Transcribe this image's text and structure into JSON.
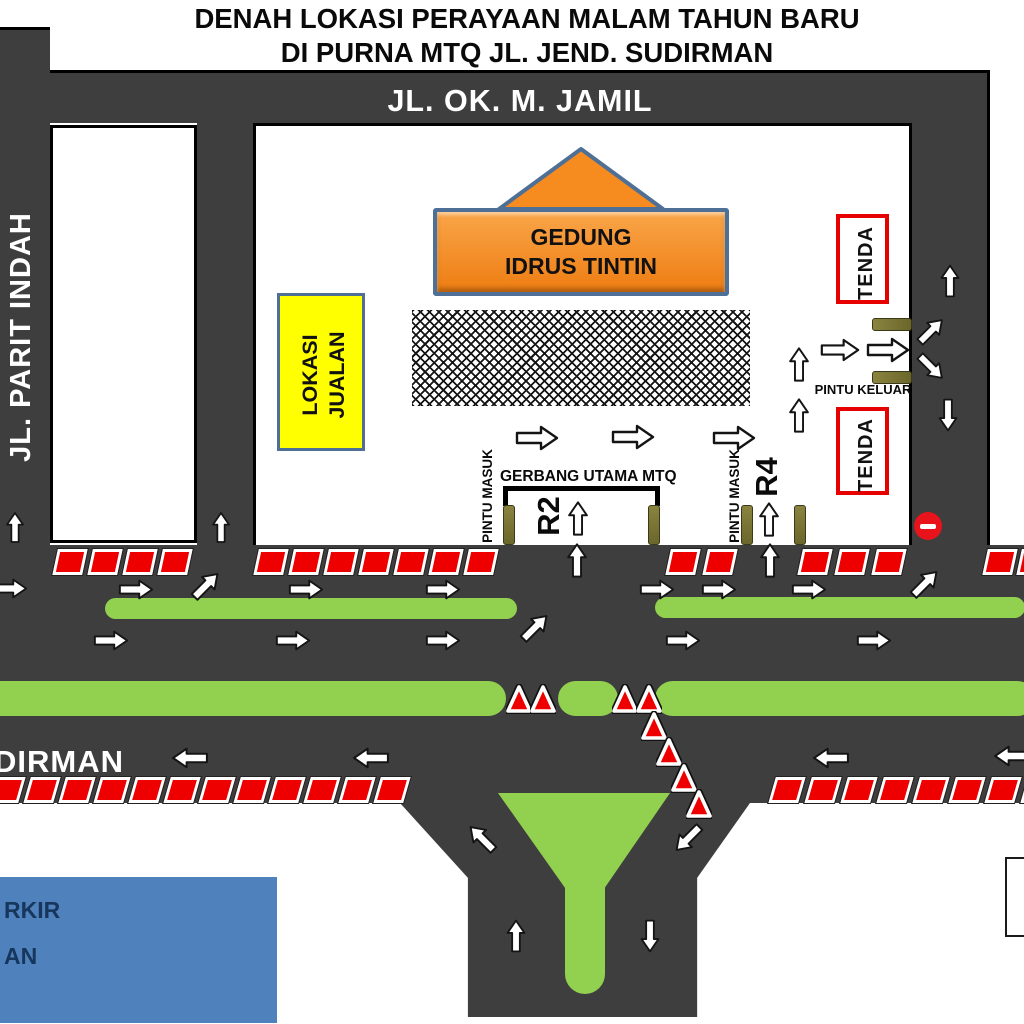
{
  "title": {
    "line1": "DENAH LOKASI PERAYAAN MALAM TAHUN BARU",
    "line2": "DI PURNA MTQ JL. JEND. SUDIRMAN"
  },
  "roads": {
    "top_label": "JL. OK. M. JAMIL",
    "left_label": "JL. PARIT INDAH",
    "bottom_label_fragment": "DIRMAN"
  },
  "venue": {
    "building": {
      "line1": "GEDUNG",
      "line2": "IDRUS TINTIN"
    },
    "market": {
      "line1": "LOKASI",
      "line2": "JUALAN"
    },
    "tent_top": "TENDA",
    "tent_bottom": "TENDA",
    "exit_label": "PINTU KELUAR",
    "entrance_label_left": "PINTU MASUK",
    "entrance_label_right": "PINTU MASUK",
    "main_gate_label": "GERBANG UTAMA MTQ",
    "lane_r2": "R2",
    "lane_r4": "R4"
  },
  "legend": {
    "fragment1": "RKIR",
    "fragment2": "AN"
  },
  "colors": {
    "road": "#3e3e3e",
    "median_green": "#92d050",
    "barrier_red": "#ee0000",
    "building_orange": "#f68b1f",
    "building_border": "#4e6f96",
    "market_yellow": "#ffff00",
    "tent_border": "#e60000",
    "legend_blue": "#4f81bd",
    "post_olive": "#75702e",
    "noentry_red": "#e8131b"
  },
  "map_elements": {
    "arrows": [
      {
        "x": 537,
        "y": 438,
        "d": "right",
        "w": 44
      },
      {
        "x": 633,
        "y": 437,
        "d": "right",
        "w": 44
      },
      {
        "x": 734,
        "y": 438,
        "d": "right",
        "w": 44
      },
      {
        "x": 799,
        "y": 364,
        "d": "up",
        "w": 36
      },
      {
        "x": 799,
        "y": 415,
        "d": "up",
        "w": 36
      },
      {
        "x": 840,
        "y": 350,
        "d": "right",
        "w": 40
      },
      {
        "x": 888,
        "y": 350,
        "d": "right",
        "w": 44
      },
      {
        "x": 578,
        "y": 518,
        "d": "up",
        "w": 36
      },
      {
        "x": 769,
        "y": 519,
        "d": "up",
        "w": 36
      },
      {
        "x": 15,
        "y": 527,
        "d": "up",
        "w": 32
      },
      {
        "x": 221,
        "y": 527,
        "d": "up",
        "w": 32
      },
      {
        "x": 10,
        "y": 588,
        "d": "right",
        "w": 36
      },
      {
        "x": 136,
        "y": 589,
        "d": "right",
        "w": 36
      },
      {
        "x": 206,
        "y": 585,
        "d": "ne",
        "w": 36
      },
      {
        "x": 306,
        "y": 589,
        "d": "right",
        "w": 36
      },
      {
        "x": 443,
        "y": 589,
        "d": "right",
        "w": 36
      },
      {
        "x": 577,
        "y": 560,
        "d": "up",
        "w": 36
      },
      {
        "x": 657,
        "y": 589,
        "d": "right",
        "w": 36
      },
      {
        "x": 719,
        "y": 589,
        "d": "right",
        "w": 36
      },
      {
        "x": 770,
        "y": 560,
        "d": "up",
        "w": 36
      },
      {
        "x": 809,
        "y": 589,
        "d": "right",
        "w": 36
      },
      {
        "x": 925,
        "y": 583,
        "d": "ne",
        "w": 36
      },
      {
        "x": 950,
        "y": 281,
        "d": "up",
        "w": 34
      },
      {
        "x": 931,
        "y": 331,
        "d": "ne",
        "w": 34
      },
      {
        "x": 931,
        "y": 367,
        "d": "se",
        "w": 34
      },
      {
        "x": 948,
        "y": 415,
        "d": "down",
        "w": 34
      },
      {
        "x": 111,
        "y": 640,
        "d": "right",
        "w": 36
      },
      {
        "x": 293,
        "y": 640,
        "d": "right",
        "w": 36
      },
      {
        "x": 443,
        "y": 640,
        "d": "right",
        "w": 36
      },
      {
        "x": 535,
        "y": 627,
        "d": "ne",
        "w": 36
      },
      {
        "x": 683,
        "y": 640,
        "d": "right",
        "w": 36
      },
      {
        "x": 874,
        "y": 640,
        "d": "right",
        "w": 36
      },
      {
        "x": 190,
        "y": 758,
        "d": "left",
        "w": 38
      },
      {
        "x": 371,
        "y": 758,
        "d": "left",
        "w": 38
      },
      {
        "x": 831,
        "y": 758,
        "d": "left",
        "w": 38
      },
      {
        "x": 1012,
        "y": 756,
        "d": "left",
        "w": 38
      },
      {
        "x": 482,
        "y": 838,
        "d": "nw",
        "w": 36
      },
      {
        "x": 688,
        "y": 838,
        "d": "sw",
        "w": 36
      },
      {
        "x": 516,
        "y": 936,
        "d": "up",
        "w": 34
      },
      {
        "x": 650,
        "y": 936,
        "d": "down",
        "w": 34
      }
    ],
    "barrier_rows": [
      {
        "x": 55,
        "y": 549,
        "count": 4,
        "step": 35,
        "skew": -12
      },
      {
        "x": 256,
        "y": 549,
        "count": 7,
        "step": 35,
        "skew": -12
      },
      {
        "x": 668,
        "y": 549,
        "count": 2,
        "step": 37,
        "skew": -12
      },
      {
        "x": 800,
        "y": 549,
        "count": 3,
        "step": 37,
        "skew": -12
      },
      {
        "x": 985,
        "y": 549,
        "count": 2,
        "step": 34,
        "skew": -12
      },
      {
        "x": -8,
        "y": 777,
        "count": 12,
        "step": 35,
        "skew": -16
      },
      {
        "x": 772,
        "y": 777,
        "count": 8,
        "step": 36,
        "skew": -16
      }
    ],
    "cones": [
      {
        "x": 506,
        "y": 684
      },
      {
        "x": 530,
        "y": 684
      },
      {
        "x": 612,
        "y": 684
      },
      {
        "x": 636,
        "y": 684
      },
      {
        "x": 641,
        "y": 711
      },
      {
        "x": 656,
        "y": 737
      },
      {
        "x": 671,
        "y": 763
      },
      {
        "x": 686,
        "y": 789
      }
    ],
    "medians": [
      {
        "x": 105,
        "y": 598,
        "w": 412,
        "h": 21
      },
      {
        "x": 655,
        "y": 597,
        "w": 370,
        "h": 21
      },
      {
        "x": -20,
        "y": 681,
        "w": 526,
        "h": 35
      },
      {
        "x": 558,
        "y": 681,
        "w": 60,
        "h": 35
      },
      {
        "x": 655,
        "y": 681,
        "w": 380,
        "h": 35
      }
    ],
    "posts_vertical": [
      {
        "x": 503,
        "y": 505
      },
      {
        "x": 648,
        "y": 505
      },
      {
        "x": 741,
        "y": 505
      },
      {
        "x": 794,
        "y": 505
      }
    ],
    "posts_horizontal": [
      {
        "x": 872,
        "y": 318
      },
      {
        "x": 872,
        "y": 371
      }
    ]
  }
}
